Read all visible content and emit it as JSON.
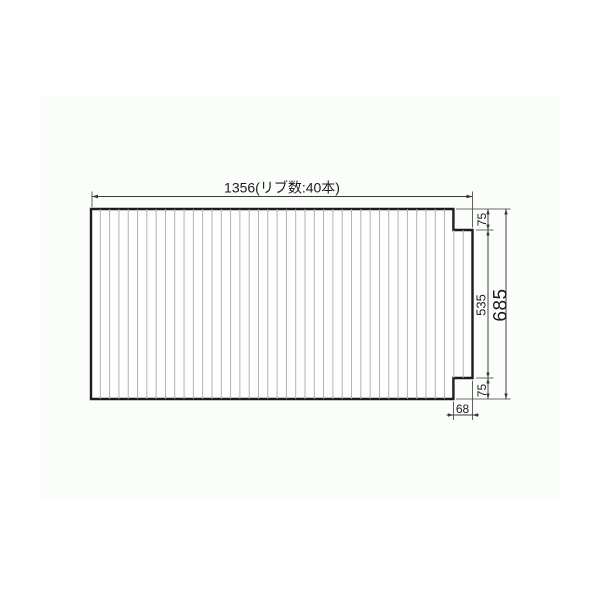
{
  "page": {
    "background": "#ffffff",
    "panel_background": "#fbfdfb"
  },
  "drawing": {
    "type": "technical-dimension-diagram",
    "subject": "ribbed bath lid panel with right-side tab",
    "rib_count": 40,
    "labels": {
      "width": "1356(リブ数:40本)",
      "total_height": "685",
      "inner_height": "535",
      "top_offset": "75",
      "bottom_offset": "75",
      "notch_width": "68"
    },
    "colors": {
      "outline": "#1c1c1c",
      "rib": "#a8adad",
      "dimension": "#3a3a3a",
      "text": "#1c1c1c"
    }
  }
}
